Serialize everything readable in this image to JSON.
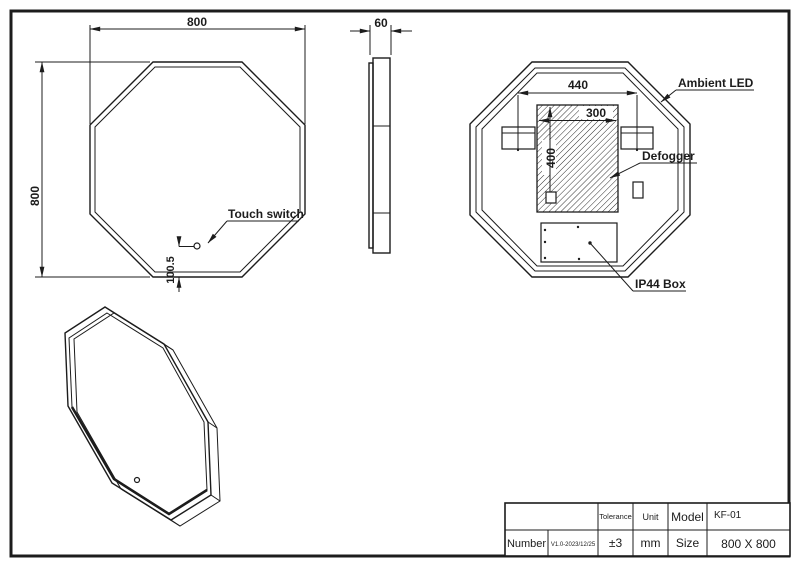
{
  "drawing": {
    "front_view": {
      "width": "800",
      "height": "800",
      "touch_offset": "100.5",
      "touch_label": "Touch switch"
    },
    "side_view": {
      "depth": "60"
    },
    "back_view": {
      "mount_span": "440",
      "defogger_width": "300",
      "defogger_height": "400",
      "ambient_label": "Ambient LED",
      "defogger_label": "Defogger",
      "ip44_label": "IP44 Box"
    }
  },
  "title_block": {
    "number_label": "Number",
    "number_value": "V1.0-2023/12/25",
    "tolerance_label": "Tolerance",
    "tolerance_value": "±3",
    "unit_label": "Unit",
    "unit_value": "mm",
    "model_label": "Model",
    "model_value": "KF-01",
    "size_label": "Size",
    "size_value": "800 X 800"
  },
  "colors": {
    "line": "#1c1c1c",
    "background": "#ffffff"
  }
}
